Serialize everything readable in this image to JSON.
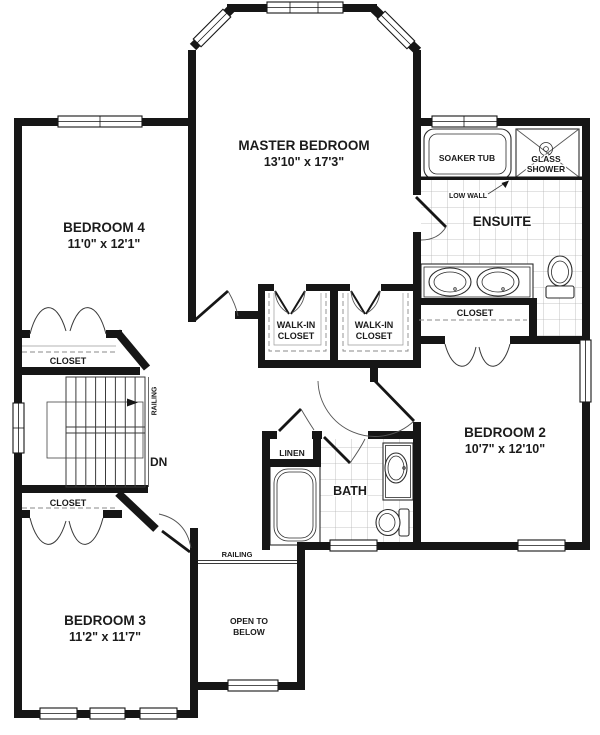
{
  "plan": {
    "title": "Second floor plan",
    "rooms": {
      "master": {
        "name": "MASTER BEDROOM",
        "dims": "13'10\" x 17'3\""
      },
      "bedroom4": {
        "name": "BEDROOM 4",
        "dims": "11'0\" x 12'1\""
      },
      "bedroom2": {
        "name": "BEDROOM 2",
        "dims": "10'7\" x 12'10\""
      },
      "bedroom3": {
        "name": "BEDROOM 3",
        "dims": "11'2\" x 11'7\""
      },
      "ensuite": {
        "name": "ENSUITE"
      },
      "bath": {
        "name": "BATH"
      },
      "linen": {
        "name": "LINEN"
      },
      "wic_left": {
        "line1": "WALK-IN",
        "line2": "CLOSET"
      },
      "wic_right": {
        "line1": "WALK-IN",
        "line2": "CLOSET"
      },
      "closet_bedroom4": {
        "name": "CLOSET"
      },
      "closet_bedroom2": {
        "name": "CLOSET"
      },
      "closet_bedroom3": {
        "name": "CLOSET"
      },
      "open_to_below": {
        "line1": "OPEN TO",
        "line2": "BELOW"
      }
    },
    "fixtures": {
      "soaker_tub": "SOAKER TUB",
      "glass_shower_line1": "GLASS",
      "glass_shower_line2": "SHOWER",
      "low_wall": "LOW WALL"
    },
    "annotations": {
      "railing_stairs": "RAILING",
      "railing_landing": "RAILING",
      "down": "DN"
    },
    "colors": {
      "wall": "#161616",
      "tile": "#b5b5b5",
      "dash": "#8a8a8a",
      "background": "#ffffff"
    }
  }
}
